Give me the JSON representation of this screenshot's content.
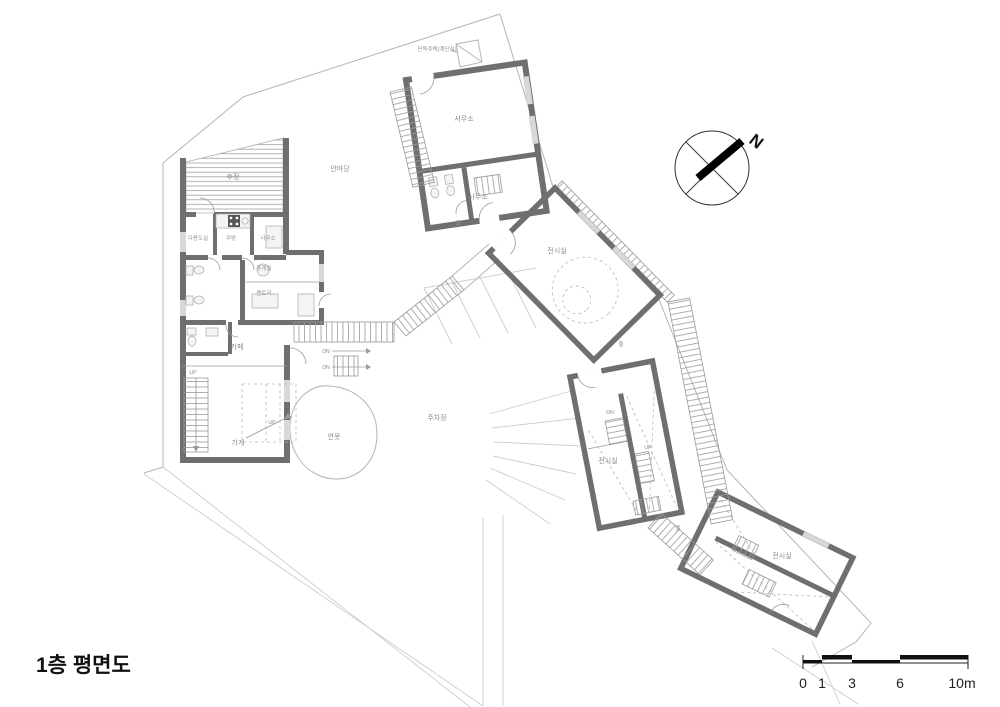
{
  "title": "1층 평면도",
  "compass": {
    "label": "N"
  },
  "scale_bar": {
    "labels": [
      "0",
      "1",
      "3",
      "6",
      "10m"
    ]
  },
  "annotations": {
    "site_note": "단독주택(계단실)",
    "rear_yard": "후정",
    "courtyard": "안마당",
    "pond": "연못",
    "parking": "주차장",
    "yard": "뜰"
  },
  "rooms": {
    "utility": "다용도실",
    "kitchen": "주방",
    "office_annex": "사무소",
    "lounge": "휴게실",
    "entry": "엔트리",
    "cafe": "카페",
    "shop": "가게",
    "office_upper": "사무소",
    "office_lower": "사무소",
    "exhibition": "전시실"
  },
  "stairs": {
    "up": "UP",
    "dn": "DN"
  },
  "colors": {
    "wall": "#6f6f6f",
    "line": "#b5b5b5",
    "hatch": "#9a9a9a",
    "label": "#8d8d8d",
    "ink": "#111111"
  }
}
